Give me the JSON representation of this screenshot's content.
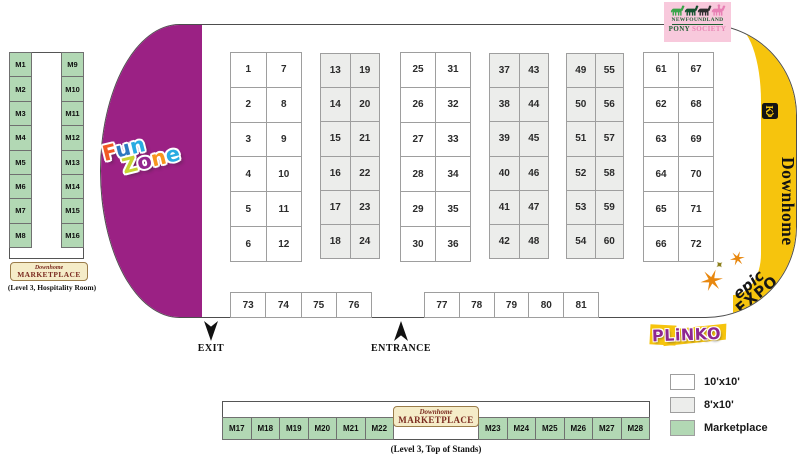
{
  "colors": {
    "fun_zone_purple": "#9B2184",
    "downhome_yellow": "#F6C40D",
    "marketplace_green": "#B2D8B4",
    "booth_gray": "#ECEDEB",
    "booth_white": "#FFFFFF",
    "pony_pink": "#F8C9DC",
    "plinko_purple": "#8E2790",
    "badge_cream": "#F5ECC8",
    "badge_text": "#7B2B20"
  },
  "hall": {
    "exit_label": "EXIT",
    "entrance_label": "ENTRANCE",
    "booth_groups": [
      {
        "size": "10'x10'",
        "numbers": [
          1,
          2,
          3,
          4,
          5,
          6,
          7,
          8,
          9,
          10,
          11,
          12
        ]
      },
      {
        "size": "8'x10'",
        "numbers": [
          13,
          14,
          15,
          16,
          17,
          18,
          19,
          20,
          21,
          22,
          23,
          24
        ]
      },
      {
        "size": "10'x10'",
        "numbers": [
          25,
          26,
          27,
          28,
          29,
          30,
          31,
          32,
          33,
          34,
          35,
          36
        ]
      },
      {
        "size": "8'x10'",
        "numbers": [
          37,
          38,
          39,
          40,
          41,
          42,
          43,
          44,
          45,
          46,
          47,
          48
        ]
      },
      {
        "size": "8'x10'",
        "numbers": [
          49,
          50,
          51,
          52,
          53,
          54,
          55,
          56,
          57,
          58,
          59,
          60
        ]
      },
      {
        "size": "10'x10'",
        "numbers": [
          61,
          62,
          63,
          64,
          65,
          66,
          67,
          68,
          69,
          70,
          71,
          72
        ]
      }
    ],
    "bottom_rows": [
      {
        "size": "10'x10'",
        "numbers": [
          73,
          74,
          75,
          76
        ]
      },
      {
        "size": "10'x10'",
        "numbers": [
          77,
          78,
          79,
          80,
          81
        ]
      }
    ]
  },
  "left_marketplace": {
    "col1": [
      "M1",
      "M2",
      "M3",
      "M4",
      "M5",
      "M6",
      "M7",
      "M8"
    ],
    "col2": [
      "M9",
      "M10",
      "M11",
      "M12",
      "M13",
      "M14",
      "M15",
      "M16"
    ],
    "caption": "(Level 3, Hospitality Room)"
  },
  "bottom_marketplace": {
    "left_cells": [
      "M17",
      "M18",
      "M19",
      "M20",
      "M21",
      "M22"
    ],
    "right_cells": [
      "M23",
      "M24",
      "M25",
      "M26",
      "M27",
      "M28"
    ],
    "caption": "(Level 3, Top of Stands)"
  },
  "marketplace_badge": {
    "script": "Downhome",
    "main": "MARKETPLACE"
  },
  "legend": {
    "items": [
      {
        "swatch": "white",
        "label": "10'x10'"
      },
      {
        "swatch": "gray",
        "label": "8'x10'"
      },
      {
        "swatch": "green",
        "label": "Marketplace"
      }
    ]
  },
  "pony_society": {
    "line1": "NEWFOUNDLAND",
    "pony": "PONY",
    "society": "SOCIETY"
  },
  "downhome": {
    "wordmark": "Downhome"
  },
  "epic_expo": {
    "line1": "epic",
    "line2": "EXPO"
  },
  "plinko": {
    "text": "PLiNKO"
  },
  "fun_zone": {
    "word1": [
      {
        "ch": "F",
        "color": "#F15A24"
      },
      {
        "ch": "u",
        "color": "#2E79C0"
      },
      {
        "ch": "n",
        "color": "#29ABE2"
      }
    ],
    "word2": [
      {
        "ch": "Z",
        "color": "#C8D431"
      },
      {
        "ch": "o",
        "color": "#93268F"
      },
      {
        "ch": "n",
        "color": "#F7941E"
      },
      {
        "ch": "e",
        "color": "#29ABE2"
      }
    ]
  }
}
